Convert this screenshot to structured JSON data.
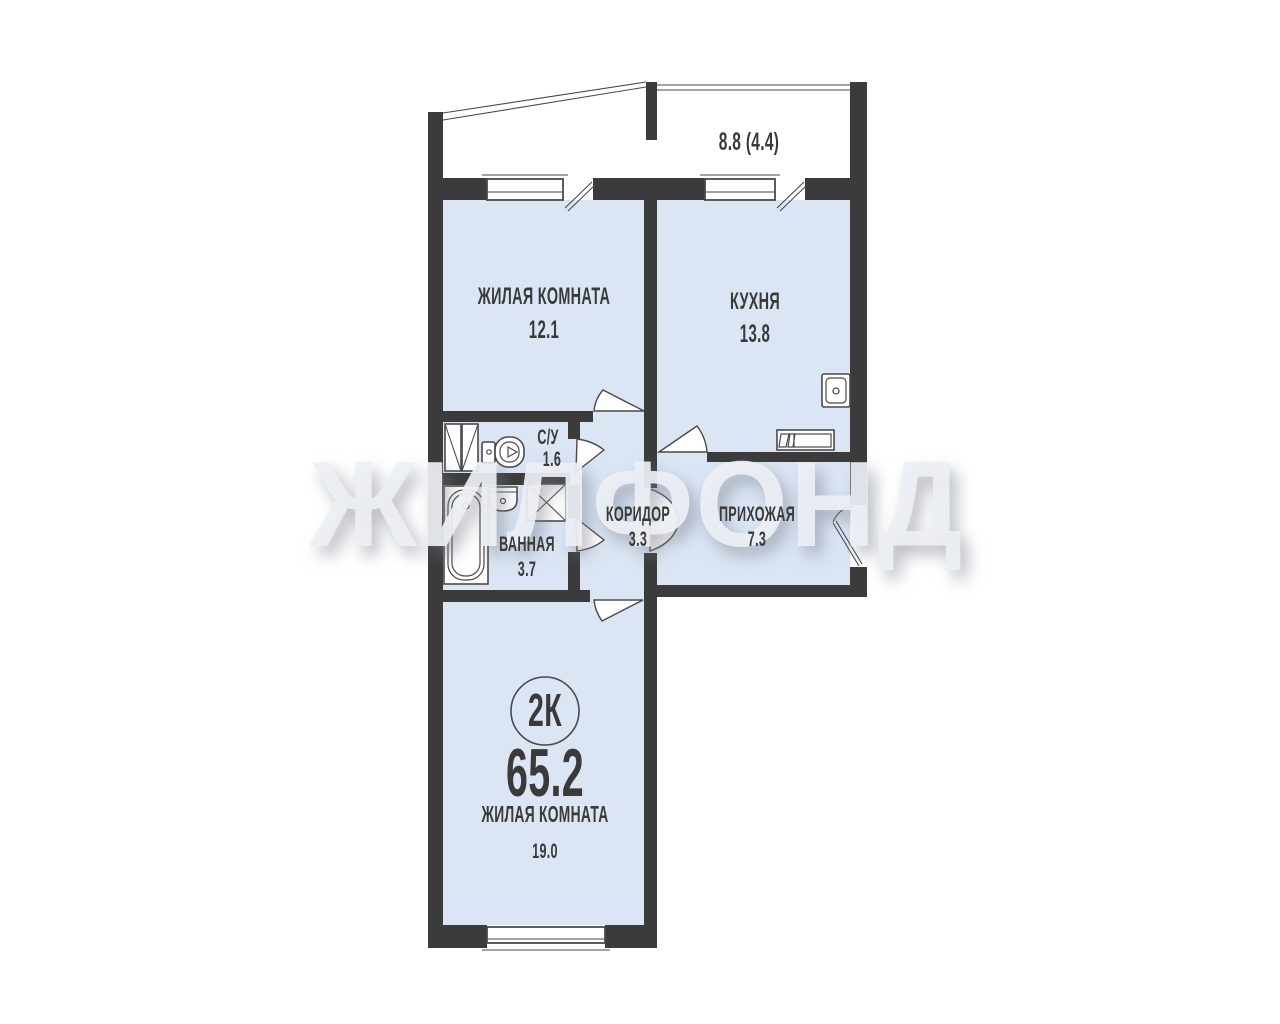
{
  "watermark": "ЖИЛФОНД",
  "balcony": {
    "area_label": "8.8 (4.4)"
  },
  "rooms": {
    "living1": {
      "name": "ЖИЛАЯ КОМНАТА",
      "area": "12.1"
    },
    "kitchen": {
      "name": "КУХНЯ",
      "area": "13.8"
    },
    "wc": {
      "name": "С/У",
      "area": "1.6"
    },
    "bath": {
      "name": "ВАННАЯ",
      "area": "3.7"
    },
    "corridor": {
      "name": "КОРИДОР",
      "area": "3.3"
    },
    "hall": {
      "name": "ПРИХОЖАЯ",
      "area": "7.3"
    },
    "living2": {
      "name": "ЖИЛАЯ КОМНАТА",
      "area": "19.0"
    }
  },
  "summary": {
    "type_badge": "2К",
    "total_area": "65.2"
  },
  "colors": {
    "wall": "#3b3b3b",
    "floor": "#dbe5f4",
    "line": "#4a4a4a",
    "label": "#3a3a3a"
  }
}
